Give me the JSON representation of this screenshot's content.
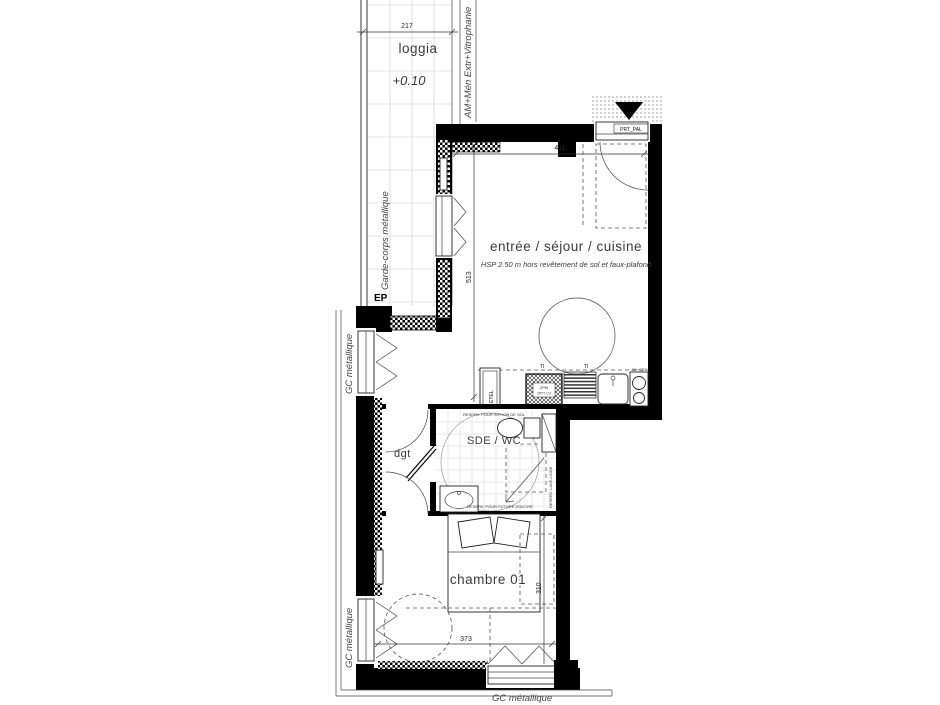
{
  "plan": {
    "title": "floor-plan",
    "rooms": {
      "loggia": {
        "label": "loggia",
        "level": "+0.10"
      },
      "sejour": {
        "label": "entrée / séjour / cuisine",
        "note": "HSP 2.50 m hors revêtement de sol et faux-plafond"
      },
      "sde": {
        "label": "SDE / WC"
      },
      "dgt": {
        "label": "dgt"
      },
      "chambre": {
        "label": "chambre 01"
      }
    },
    "dimensions": {
      "loggia_width": "217",
      "sejour_width": "411",
      "sejour_height": "513",
      "chambre_height": "310",
      "chambre_width": "373"
    },
    "annotations": {
      "garde_corps": "Garde-corps métallique",
      "am_men": "AM+Mén Extr+Vitrophanie",
      "ep": "EP",
      "gc_left_upper": "GC métallique",
      "gc_left_lower": "GC métallique",
      "gc_bottom": "GC métallique",
      "door_label": "PRT_PAL",
      "etel": "ETEL",
      "ti_1": "TI",
      "ti_2": "TI",
      "appliance_line1": "2PM",
      "appliance_line2": "OPT LV",
      "cooktop": "AB+C23",
      "sde_note_top": "RESERV. POUR SIPHON DE SOL",
      "sde_note_bottom": "RESERV. POUR FUTURE DOUCHE",
      "sde_note_ll": "RESERV. LAVE-LINGE"
    },
    "colors": {
      "wall": "#000000",
      "line": "#333333",
      "grid": "#cccccc",
      "text": "#3a3a3a"
    }
  }
}
